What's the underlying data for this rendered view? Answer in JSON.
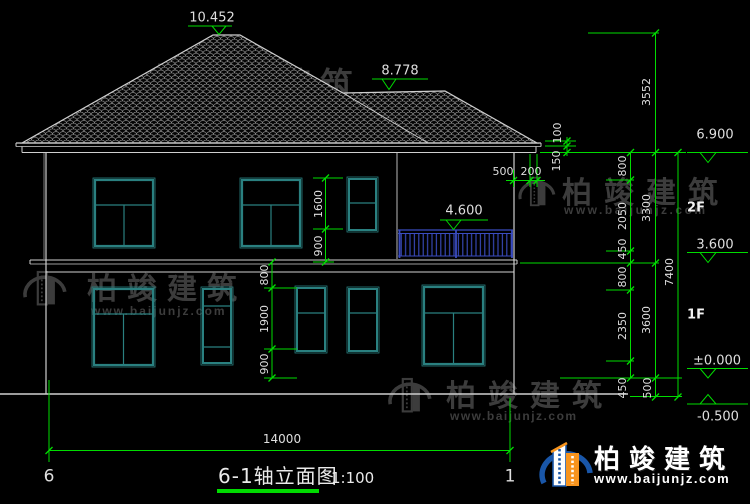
{
  "drawing": {
    "title": "6-1轴立面图",
    "scale": "1:100",
    "axes": {
      "left": "6",
      "right": "1"
    },
    "total_width_dim": "14000",
    "levels": {
      "ridge": "10.452",
      "secondary_ridge": "8.778",
      "eave": "6.900",
      "balcony_rail": "4.600",
      "floor2": "3.600",
      "floor1_zero": "±0.000",
      "ground": "-0.500"
    },
    "floor_labels": {
      "f2": "2F",
      "f1": "1F"
    },
    "dims": {
      "eave_overhang": [
        "500",
        "200"
      ],
      "eave_detail": [
        "100",
        "150"
      ],
      "right_inner": [
        "800",
        "2050",
        "450",
        "800",
        "2350",
        "450"
      ],
      "right_mid": [
        "3552",
        "3300",
        "3600",
        "500"
      ],
      "right_outer": [
        "7400"
      ],
      "left_2f": [
        "1600",
        "900"
      ],
      "left_1f": [
        "800",
        "1900",
        "900"
      ]
    }
  },
  "watermark": {
    "name": "柏竣建筑",
    "url": "www.baijunjz.com"
  },
  "brand": {
    "name": "柏竣建筑",
    "url": "www.baijunjz.com"
  },
  "colors": {
    "dim_green": "#00dc00",
    "frame_teal": "#2a8080",
    "railing_blue": "#3a4cc0",
    "axis_red": "#c83232",
    "brand_blue": "#1956a8",
    "brand_orange": "#f7941e"
  }
}
